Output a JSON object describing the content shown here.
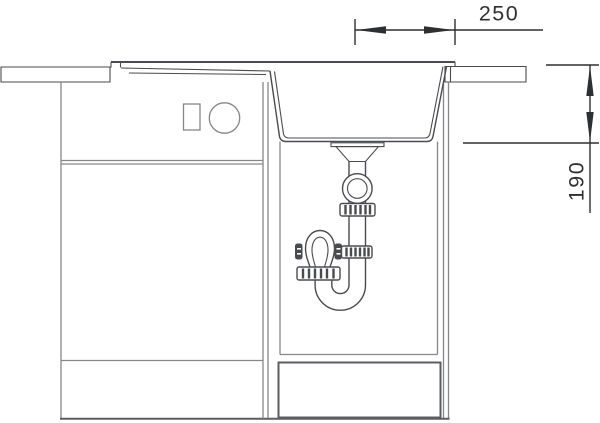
{
  "dimensions": {
    "horizontal": {
      "value": "250"
    },
    "vertical": {
      "value": "190"
    }
  },
  "colors": {
    "dimension_ink": "#2e2f31",
    "drawing_ink": "#4a4b4e",
    "cabinet_ink": "#85878a",
    "background": "#ffffff"
  }
}
